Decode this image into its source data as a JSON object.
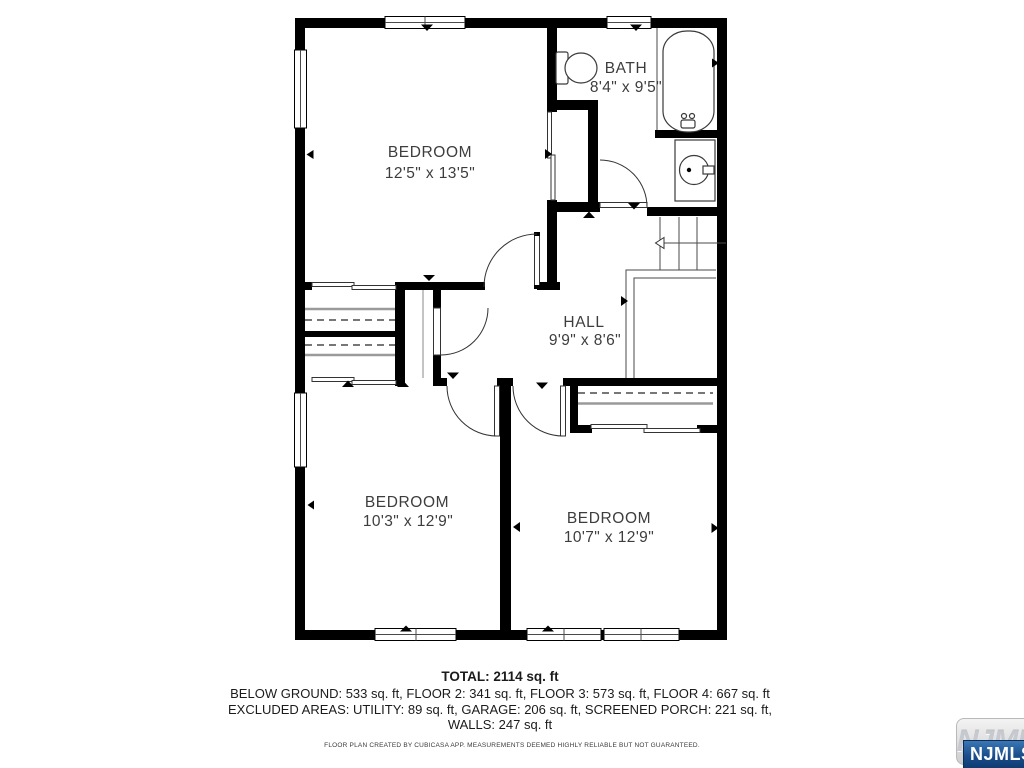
{
  "plan": {
    "rooms": [
      {
        "name": "BEDROOM",
        "dims": "12'5\" x 13'5\""
      },
      {
        "name": "BATH",
        "dims": "8'4\" x 9'5\""
      },
      {
        "name": "HALL",
        "dims": "9'9\" x 8'6\""
      },
      {
        "name": "BEDROOM",
        "dims": "10'3\" x 12'9\""
      },
      {
        "name": "BEDROOM",
        "dims": "10'7\" x 12'9\""
      }
    ],
    "fixtures": [
      "toilet",
      "bathtub",
      "sink",
      "vanity",
      "stairs",
      "closets"
    ]
  },
  "summary": {
    "total": "TOTAL: 2114 sq. ft",
    "areas_line": "BELOW GROUND: 533 sq. ft, FLOOR 2: 341 sq. ft, FLOOR 3: 573 sq. ft, FLOOR 4: 667 sq. ft",
    "excluded_line": "EXCLUDED AREAS: UTILITY: 89 sq. ft, GARAGE: 206 sq. ft, SCREENED PORCH: 221 sq. ft,",
    "walls_line": "WALLS: 247 sq. ft",
    "disclaimer": "FLOOR PLAN CREATED BY CUBICASA APP. MEASUREMENTS DEEMED HIGHLY RELIABLE BUT NOT GUARANTEED."
  },
  "logo": {
    "watermark_text": "NJMLS",
    "badge_text": "NJMLS"
  },
  "colors": {
    "wall": "#000000",
    "room_label": "#3d3d3d",
    "badge_blue_top": "#3a77b4",
    "badge_blue_bottom": "#0c3a70"
  }
}
